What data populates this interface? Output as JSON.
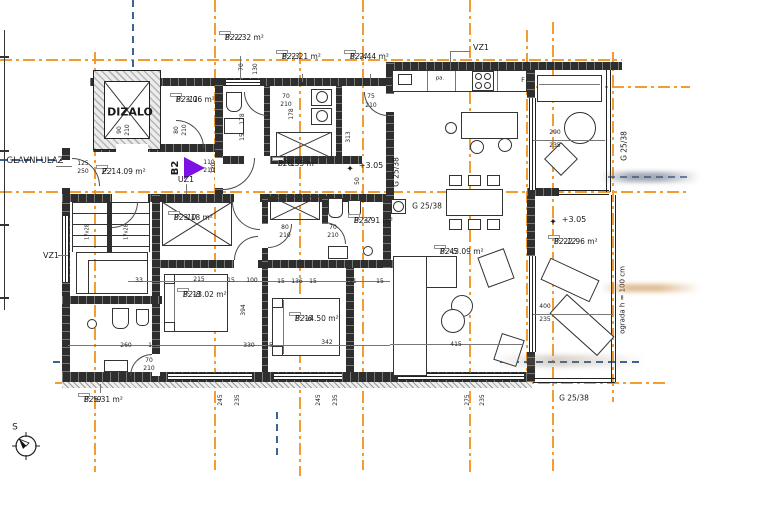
{
  "drawing": {
    "type": "apartment-floor-plan",
    "apartment_id": "B2",
    "level_marks": [
      "+3.05",
      "+3.05"
    ]
  },
  "colors": {
    "grid_line": "#F0921E",
    "reference_line": "#3D6391",
    "wall": "#2E2E2E",
    "apartment_arrow": "#7C10E6"
  },
  "rooms": [
    {
      "code": "B2-2",
      "area": "P: 2.32 m²",
      "x": 219,
      "y": 31
    },
    {
      "code": "B2-3",
      "area": "P: 2.21 m²",
      "x": 276,
      "y": 50
    },
    {
      "code": "B2-4",
      "area": "P: 2.44 m²",
      "x": 344,
      "y": 50
    },
    {
      "code": "B2-11",
      "area": "P: 3.06 m²",
      "x": 170,
      "y": 93
    },
    {
      "code": "Z2",
      "area": "P: 14.09 m²",
      "x": 96,
      "y": 165
    },
    {
      "code": "B2-1",
      "area": "P: 6.55 m²",
      "x": 272,
      "y": 157
    },
    {
      "code": "B2-10",
      "area": "P: 3.18 m²",
      "x": 168,
      "y": 211
    },
    {
      "code": "B2-7",
      "area": "P: 3.91 m²",
      "x": 348,
      "y": 214
    },
    {
      "code": "B2-8",
      "area": "P: 13.02 m²",
      "x": 177,
      "y": 288
    },
    {
      "code": "B2-6",
      "area": "P: 14.50 m²",
      "x": 289,
      "y": 312
    },
    {
      "code": "B2-5",
      "area": "P: 43.09 m²",
      "x": 434,
      "y": 245
    },
    {
      "code": "B2-12",
      "area": "P: 22.96 m²",
      "x": 548,
      "y": 235
    },
    {
      "code": "B2-9",
      "area": "P: 5.31 m²",
      "x": 78,
      "y": 393
    }
  ],
  "annotations": [
    {
      "t": "DIZALO",
      "x": 130,
      "y": 112,
      "s": 11,
      "b": 1
    },
    {
      "t": "GLAVNI ULAZ",
      "x": 35,
      "y": 161,
      "s": 8.5
    },
    {
      "t": "VZ1",
      "x": 51,
      "y": 256,
      "s": 8
    },
    {
      "t": "VZ1",
      "x": 481,
      "y": 48,
      "s": 8
    },
    {
      "t": "UZ1",
      "x": 186,
      "y": 180,
      "s": 8
    },
    {
      "t": "B2",
      "x": 176,
      "y": 168,
      "s": 10,
      "b": 1,
      "v": 1
    },
    {
      "t": "G 25/38",
      "x": 427,
      "y": 206,
      "s": 7.5
    },
    {
      "t": "G 25/38",
      "x": 574,
      "y": 398,
      "s": 7.5
    },
    {
      "t": "G 25/38",
      "x": 396,
      "y": 172,
      "s": 7.5,
      "v": 1
    },
    {
      "t": "G 25/38",
      "x": 624,
      "y": 146,
      "s": 7.5,
      "v": 1
    },
    {
      "t": "ograda h = 100 cm",
      "x": 623,
      "y": 300,
      "s": 7,
      "v": 1
    },
    {
      "t": "+3.05",
      "x": 371,
      "y": 166,
      "s": 8
    },
    {
      "t": "+3.05",
      "x": 574,
      "y": 220,
      "s": 8
    },
    {
      "t": "✦",
      "x": 350,
      "y": 170,
      "s": 9
    },
    {
      "t": "✦",
      "x": 553,
      "y": 223,
      "s": 9
    },
    {
      "t": "S",
      "x": 15,
      "y": 428,
      "s": 9
    },
    {
      "t": "17x28",
      "x": 88,
      "y": 232,
      "s": 5,
      "v": 1
    },
    {
      "t": "17x28",
      "x": 127,
      "y": 232,
      "s": 5,
      "v": 1
    },
    {
      "t": "pa.",
      "x": 440,
      "y": 79,
      "s": 5.5
    },
    {
      "t": "F",
      "x": 523,
      "y": 80,
      "s": 6.5
    }
  ],
  "dimensions": [
    {
      "t": "125",
      "x": 83,
      "y": 164
    },
    {
      "t": "250",
      "x": 83,
      "y": 172
    },
    {
      "t": "70",
      "x": 286,
      "y": 97
    },
    {
      "t": "210",
      "x": 286,
      "y": 105
    },
    {
      "t": "75",
      "x": 371,
      "y": 97
    },
    {
      "t": "210",
      "x": 371,
      "y": 106
    },
    {
      "t": "110",
      "x": 209,
      "y": 163
    },
    {
      "t": "210",
      "x": 209,
      "y": 171
    },
    {
      "t": "80",
      "x": 285,
      "y": 228
    },
    {
      "t": "210",
      "x": 285,
      "y": 236
    },
    {
      "t": "70",
      "x": 333,
      "y": 228
    },
    {
      "t": "210",
      "x": 333,
      "y": 236
    },
    {
      "t": "70",
      "x": 149,
      "y": 361
    },
    {
      "t": "210",
      "x": 149,
      "y": 369
    },
    {
      "t": "33",
      "x": 139,
      "y": 281
    },
    {
      "t": "215",
      "x": 199,
      "y": 280
    },
    {
      "t": "15",
      "x": 231,
      "y": 281
    },
    {
      "t": "100",
      "x": 252,
      "y": 281
    },
    {
      "t": "260",
      "x": 126,
      "y": 346
    },
    {
      "t": "15",
      "x": 152,
      "y": 346
    },
    {
      "t": "330",
      "x": 249,
      "y": 346
    },
    {
      "t": "15",
      "x": 269,
      "y": 346
    },
    {
      "t": "15",
      "x": 281,
      "y": 282
    },
    {
      "t": "136",
      "x": 297,
      "y": 282
    },
    {
      "t": "15",
      "x": 313,
      "y": 282
    },
    {
      "t": "191",
      "x": 351,
      "y": 282
    },
    {
      "t": "15",
      "x": 380,
      "y": 282
    },
    {
      "t": "342",
      "x": 327,
      "y": 343
    },
    {
      "t": "415",
      "x": 456,
      "y": 345
    },
    {
      "t": "290",
      "x": 555,
      "y": 133
    },
    {
      "t": "235",
      "x": 555,
      "y": 146
    },
    {
      "t": "400",
      "x": 545,
      "y": 307
    },
    {
      "t": "235",
      "x": 545,
      "y": 320
    },
    {
      "t": "70",
      "x": 242,
      "y": 67,
      "v": 1
    },
    {
      "t": "130",
      "x": 256,
      "y": 69,
      "v": 1
    },
    {
      "t": "178",
      "x": 243,
      "y": 119,
      "v": 1
    },
    {
      "t": "15",
      "x": 243,
      "y": 137,
      "v": 1
    },
    {
      "t": "178",
      "x": 292,
      "y": 114,
      "v": 1
    },
    {
      "t": "90",
      "x": 120,
      "y": 130,
      "v": 1
    },
    {
      "t": "210",
      "x": 128,
      "y": 130,
      "v": 1
    },
    {
      "t": "80",
      "x": 177,
      "y": 130,
      "v": 1
    },
    {
      "t": "210",
      "x": 185,
      "y": 130,
      "v": 1
    },
    {
      "t": "120",
      "x": 214,
      "y": 168,
      "v": 1
    },
    {
      "t": "313",
      "x": 349,
      "y": 137,
      "v": 1
    },
    {
      "t": "50",
      "x": 358,
      "y": 181,
      "v": 1
    },
    {
      "t": "394",
      "x": 244,
      "y": 310,
      "v": 1
    },
    {
      "t": "337",
      "x": 350,
      "y": 320,
      "v": 1
    },
    {
      "t": "245",
      "x": 221,
      "y": 400,
      "v": 1
    },
    {
      "t": "235",
      "x": 238,
      "y": 400,
      "v": 1
    },
    {
      "t": "245",
      "x": 319,
      "y": 400,
      "v": 1
    },
    {
      "t": "235",
      "x": 336,
      "y": 400,
      "v": 1
    },
    {
      "t": "275",
      "x": 468,
      "y": 400,
      "v": 1
    },
    {
      "t": "235",
      "x": 483,
      "y": 400,
      "v": 1
    }
  ]
}
